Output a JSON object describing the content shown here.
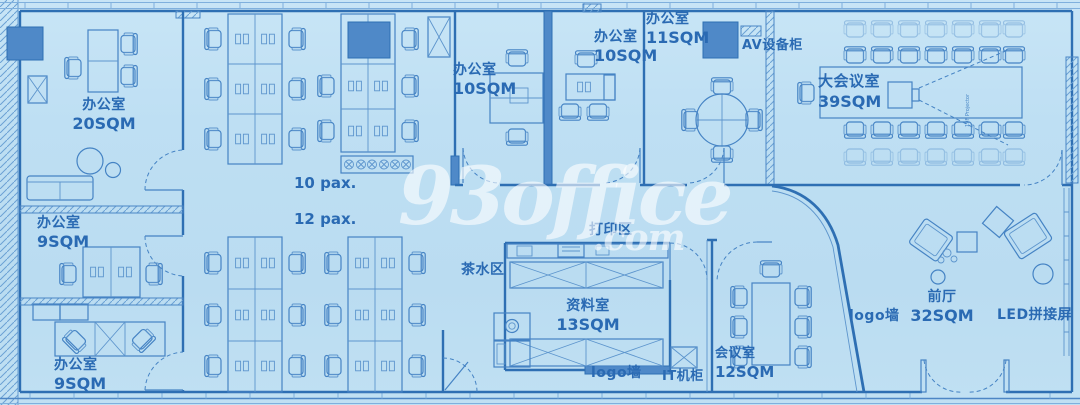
{
  "watermark": {
    "brand": "93office",
    "suffix": ".com"
  },
  "rooms": {
    "office20": {
      "name": "办公室",
      "area": "20SQM"
    },
    "office9_mid": {
      "name": "办公室",
      "area": "9SQM"
    },
    "office9_bottom": {
      "name": "办公室",
      "area": "9SQM"
    },
    "office10_a": {
      "name": "办公室",
      "area": "10SQM"
    },
    "office10_b": {
      "name": "办公室",
      "area": "10SQM"
    },
    "office11": {
      "name": "办公室",
      "area": "11SQM"
    },
    "conference": {
      "name": "大会议室",
      "area": "39SQM"
    },
    "archive": {
      "name": "资料室",
      "area": "13SQM"
    },
    "meeting": {
      "name": "会议室",
      "area": "12SQM"
    },
    "lobby": {
      "name": "前厅",
      "area": "32SQM"
    }
  },
  "zones": {
    "pax10": "10 pax.",
    "pax12": "12 pax.",
    "av_cabinet": "AV设备柜",
    "print_area": "打印区",
    "pantry": "茶水区",
    "logo_wall_center": "logo墙",
    "logo_wall_lobby": "logo墙",
    "it_cabinet": "IT机柜",
    "led_screen": "LED拼接屏",
    "projector": "19F Projector"
  },
  "colors": {
    "paper": "#bedff3",
    "line": "#4583c4",
    "wall": "#2e6fb3",
    "solid_fill": "#4f89c8",
    "label": "#2a6ab3",
    "watermark": "#ffffff"
  }
}
